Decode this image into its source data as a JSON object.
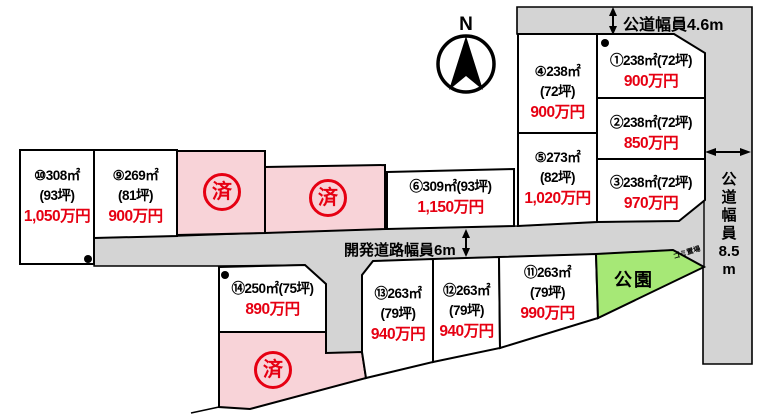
{
  "labels": {
    "north": "N",
    "sold": "済",
    "park": "公園",
    "trash": "ゴミ置場",
    "road_top": "公道幅員4.6m",
    "road_dev": "開発道路幅員6m",
    "road_right": [
      "公",
      "道",
      "幅",
      "員",
      "8.5",
      "m"
    ]
  },
  "lots": {
    "lot1": {
      "lines": [
        "①238㎡(72坪)"
      ],
      "price": "900万円"
    },
    "lot2": {
      "lines": [
        "②238㎡(72坪)"
      ],
      "price": "850万円"
    },
    "lot3": {
      "lines": [
        "③238㎡(72坪)"
      ],
      "price": "970万円"
    },
    "lot4": {
      "lines": [
        "④238㎡",
        "(72坪)"
      ],
      "price": "900万円"
    },
    "lot5": {
      "lines": [
        "⑤273㎡",
        "(82坪)"
      ],
      "price": "1,020万円"
    },
    "lot6": {
      "lines": [
        "⑥309㎡(93坪)"
      ],
      "price": "1,150万円"
    },
    "lot9": {
      "lines": [
        "⑨269㎡",
        "(81坪)"
      ],
      "price": "900万円"
    },
    "lot10": {
      "lines": [
        "⑩308㎡",
        "(93坪)"
      ],
      "price": "1,050万円"
    },
    "lot11": {
      "lines": [
        "⑪263㎡",
        "(79坪)"
      ],
      "price": "990万円"
    },
    "lot12": {
      "lines": [
        "⑫263㎡",
        "(79坪)"
      ],
      "price": "940万円"
    },
    "lot13": {
      "lines": [
        "⑬263㎡",
        "(79坪)"
      ],
      "price": "940万円"
    },
    "lot14": {
      "lines": [
        "⑭250㎡(75坪)"
      ],
      "price": "890万円"
    }
  },
  "colors": {
    "sold_fill": "#f8d3d8",
    "park_fill": "#a6e876",
    "road_fill": "#d4d4d4",
    "price_red": "#e60012",
    "line_black": "#000000"
  }
}
